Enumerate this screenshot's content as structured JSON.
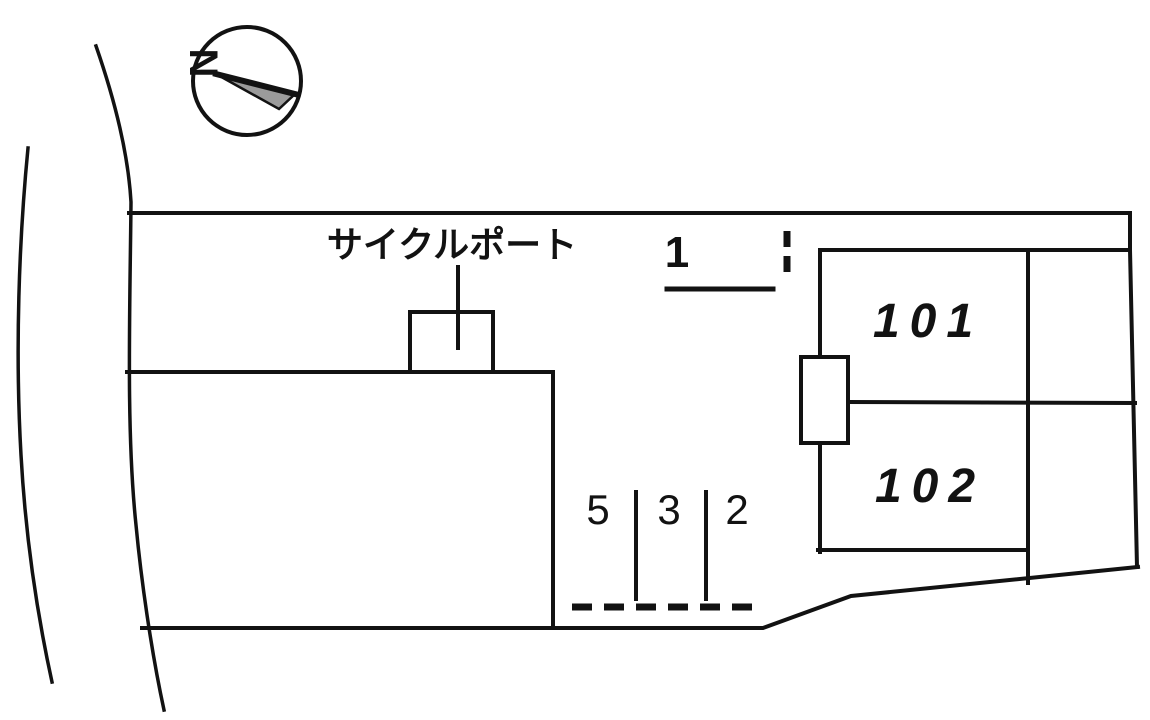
{
  "diagram": {
    "type": "site-plan",
    "compass": {
      "north_label": "N"
    },
    "structures": {
      "cycle_port_label": "サイクルポート",
      "unit_101_label": "101",
      "unit_102_label": "102"
    },
    "parking_spaces": {
      "space_1_label": "1",
      "space_5_label": "5",
      "space_3_label": "3",
      "space_2_label": "2"
    },
    "colors": {
      "line": "#121212",
      "background": "#ffffff",
      "compass_arrow_fill": "#9b9b9b"
    }
  }
}
